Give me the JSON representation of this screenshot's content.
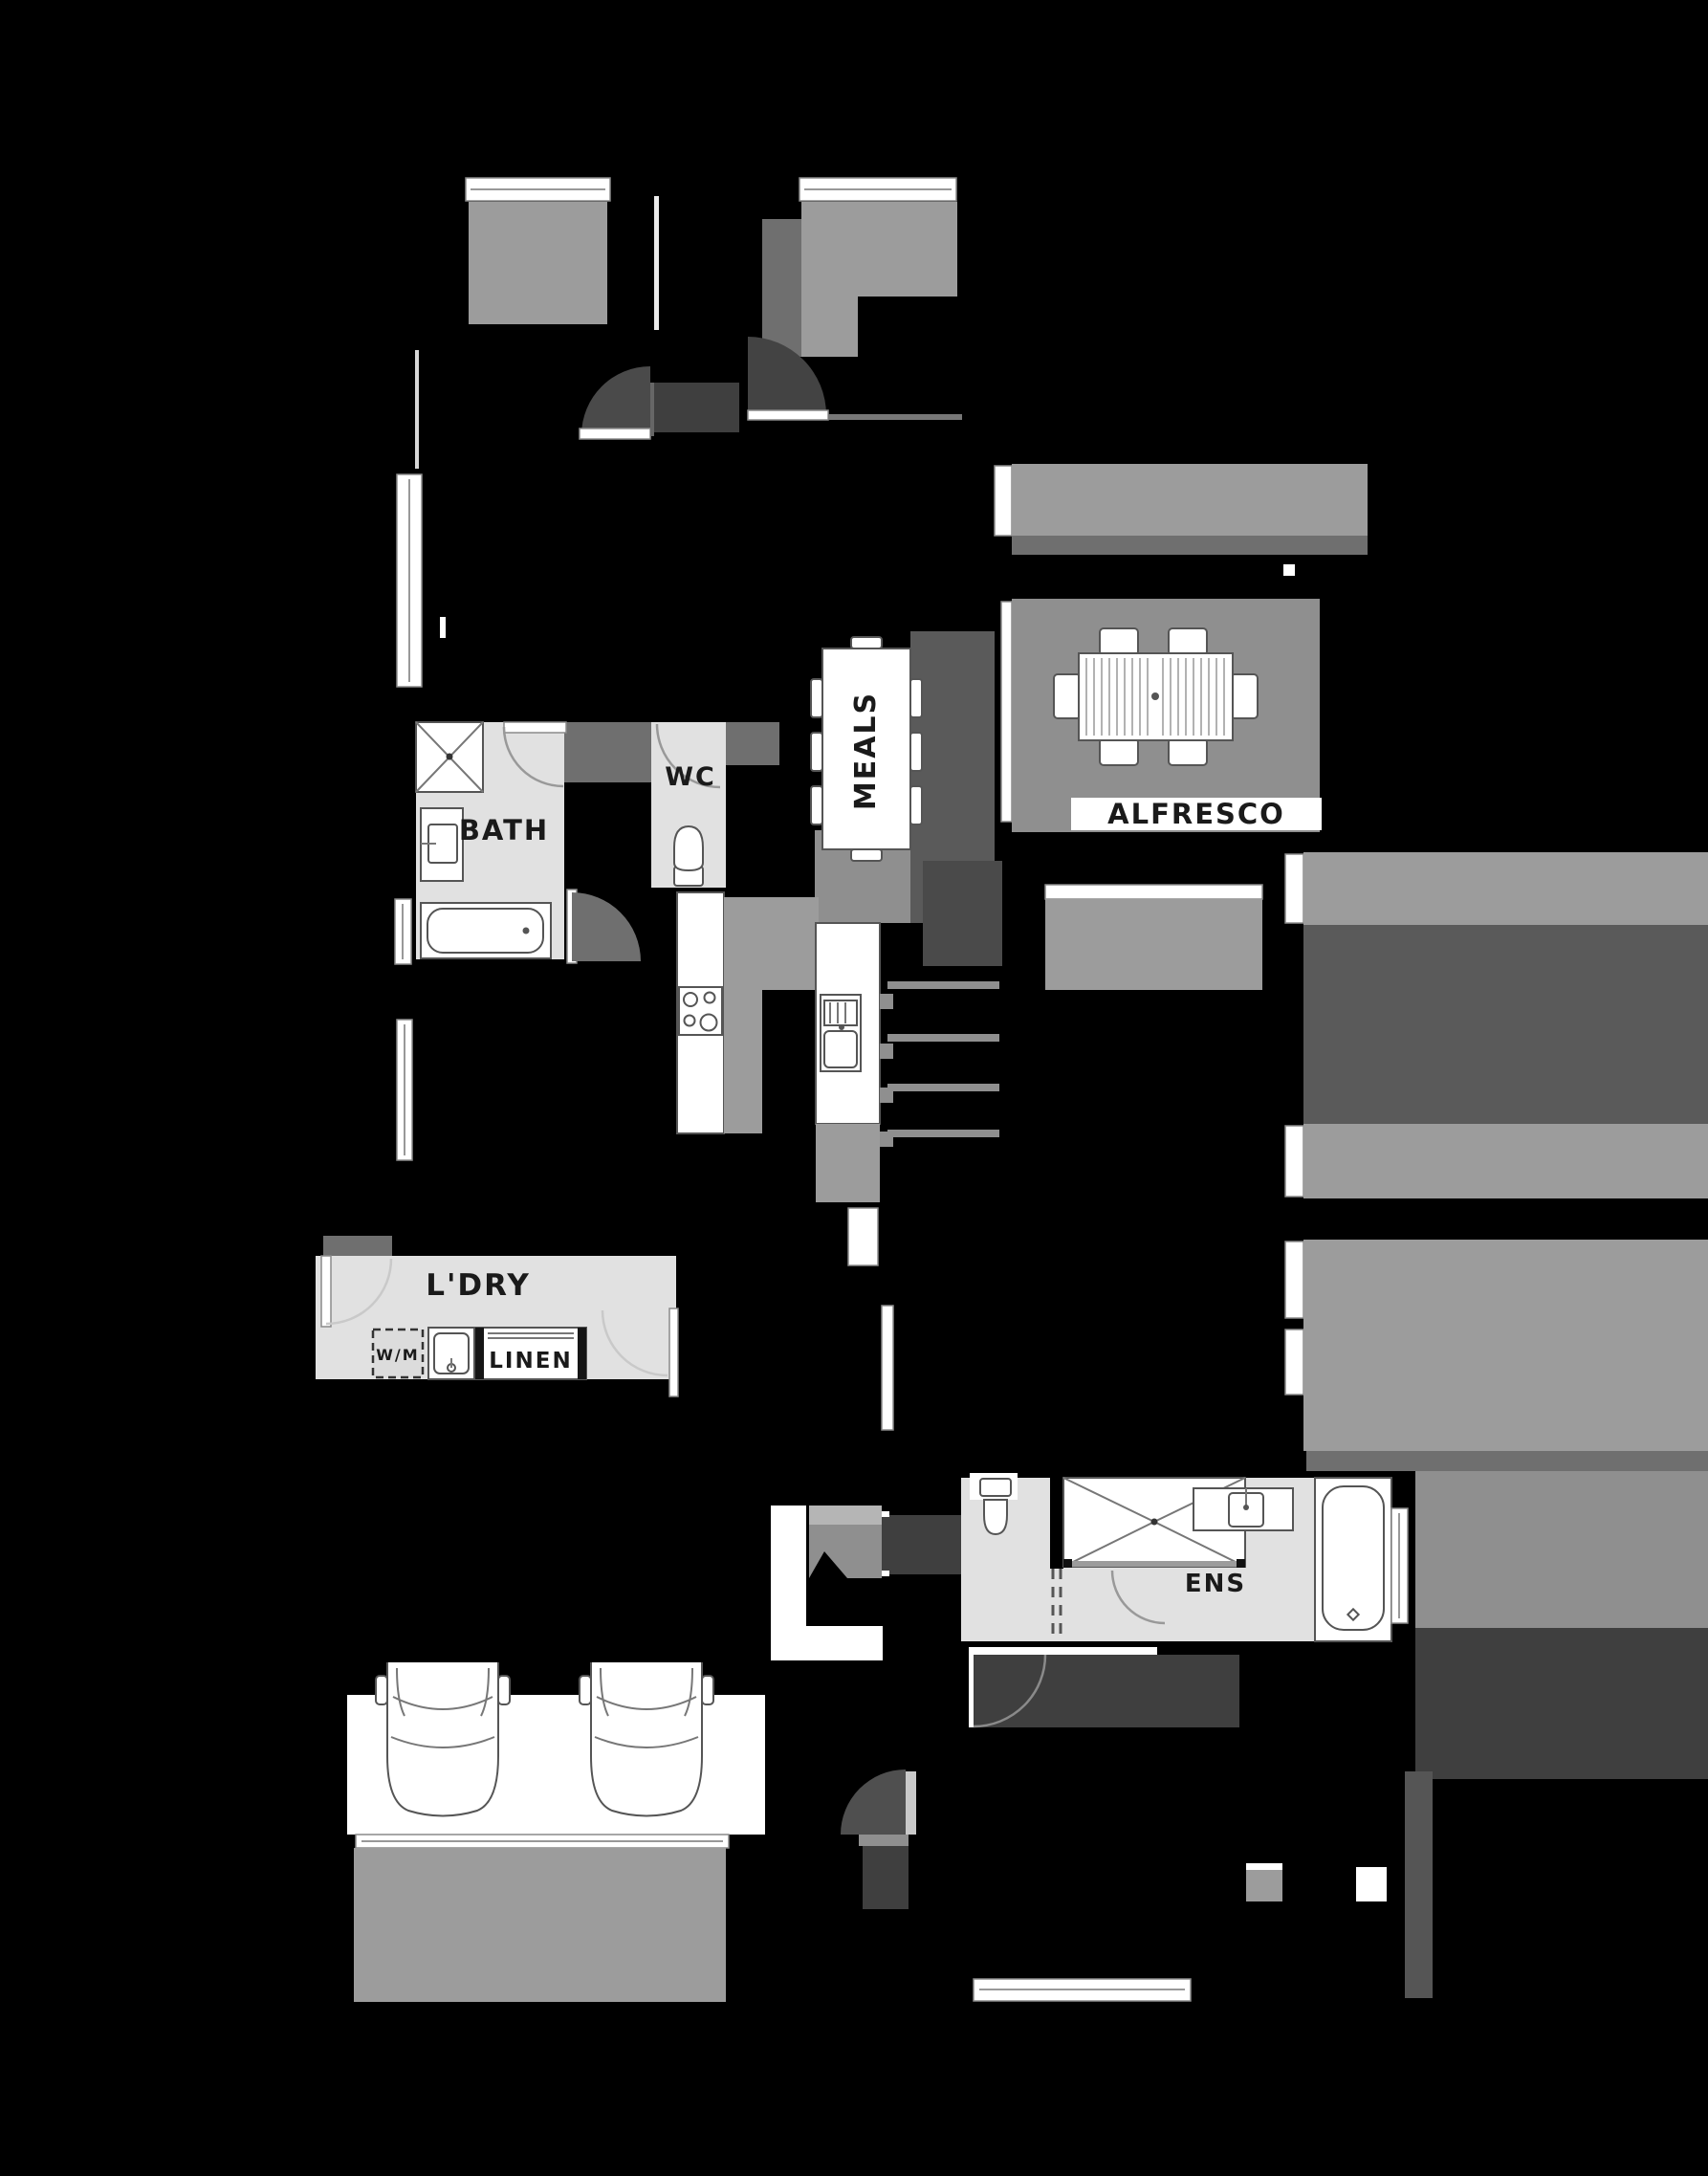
{
  "palette": {
    "background": "#000000",
    "floor_light": "#e1e1e1",
    "floor_mid": "#9c9c9c",
    "slab_gray": "#8f8f8f",
    "shadow_gray": "#6f6f6f",
    "door_swing_gray": "#4a4a4a",
    "dark_gray": "#3f3f3f",
    "fixture_white": "#ffffff",
    "outline_gray": "#555555",
    "label_black": "#1a1a1a"
  },
  "rooms": {
    "meals": {
      "label": "MEALS"
    },
    "alfresco": {
      "label": "ALFRESCO"
    },
    "bath": {
      "label": "BATH"
    },
    "wc": {
      "label": "WC"
    },
    "laundry": {
      "label": "L'DRY"
    },
    "washing_machine": {
      "label": "W/M"
    },
    "linen": {
      "label": "LINEN"
    },
    "ensuite": {
      "label": "ENS"
    }
  },
  "icons": {
    "shower": "square-with-x",
    "toilet": "tank-and-bowl",
    "bathtub": "rounded-tub",
    "vanity_sink": "square-basin-with-tap",
    "cooktop": "four-burner",
    "kitchen_sink": "double-basin",
    "laundry_tub": "square-basin",
    "washing_machine_provision": "dashed-square",
    "dining_table": "rectangle-with-8-chairs",
    "outdoor_table": "slatted-rectangle-with-6-chairs",
    "car": "top-view-car",
    "door": "quarter-circle-swing",
    "window": "double-line-bar"
  }
}
